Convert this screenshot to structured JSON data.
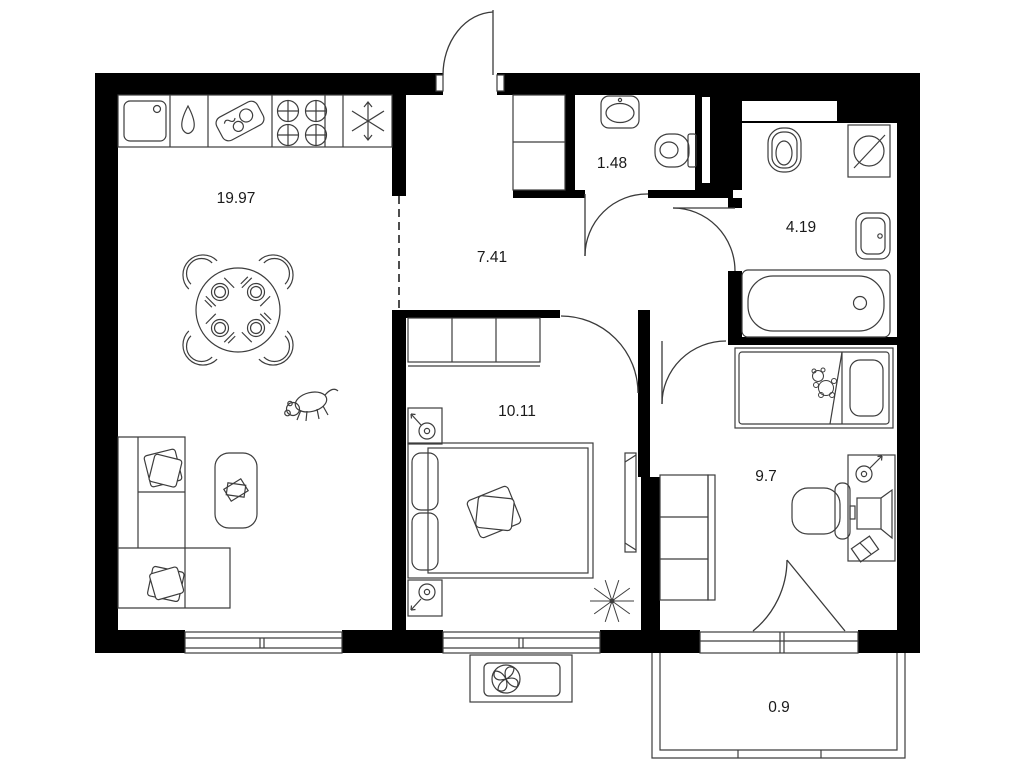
{
  "title": "Apartment floor plan",
  "rooms": [
    {
      "name": "kitchen-living-room",
      "area": "19.97"
    },
    {
      "name": "hallway",
      "area": "7.41"
    },
    {
      "name": "toilet",
      "area": "1.48"
    },
    {
      "name": "bathroom",
      "area": "4.19"
    },
    {
      "name": "bedroom",
      "area": "10.11"
    },
    {
      "name": "room",
      "area": "9.7"
    },
    {
      "name": "balcony",
      "area": "0.9"
    }
  ],
  "colors": {
    "wall": "#000000",
    "furniture_line": "#3d3d3d",
    "background": "#ffffff",
    "label_text": "#1a1a1a"
  },
  "icons": [
    "kitchen-sink-icon",
    "water-drop-icon",
    "cutting-board-icon",
    "stove-burners-icon",
    "fridge-snowflake-icon",
    "dining-table-icon",
    "chair-icon",
    "place-setting-icon",
    "dog-icon",
    "corner-sofa-icon",
    "pillow-icon",
    "coffee-table-icon",
    "book-icon",
    "hall-closet-icon",
    "wardrobe-icon",
    "double-bed-icon",
    "nightstand-lamp-icon",
    "tv-console-icon",
    "plant-icon",
    "wc-sink-icon",
    "toilet-icon",
    "washing-machine-icon",
    "bathroom-sink-icon",
    "bathtub-icon",
    "single-bed-icon",
    "teddy-bear-icon",
    "desk-icon",
    "desk-lamp-icon",
    "monitor-icon",
    "desk-chair-icon",
    "window-icon",
    "door-arc-icon",
    "entrance-door-icon",
    "air-conditioner-icon",
    "balcony-icon"
  ]
}
